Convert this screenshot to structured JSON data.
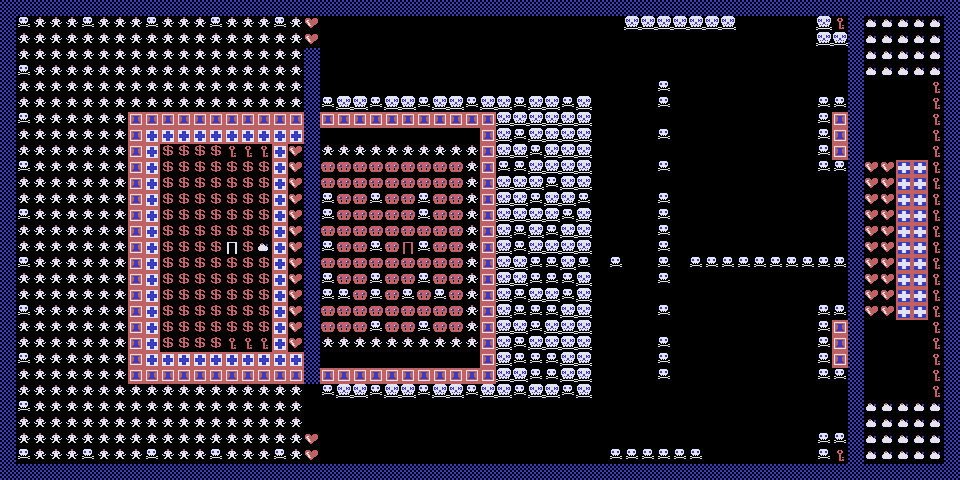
{
  "screen": {
    "type": "retro-tile-game",
    "width_tiles": 60,
    "height_tiles": 30,
    "tile_size": 16
  },
  "palette": {
    "background": "#000000",
    "blue": "#3c3cc0",
    "red": "#c16262",
    "white": "#e2e2f2",
    "black": "#000000"
  },
  "legend": {
    "#": {
      "name": "border-dither-tile",
      "interactable": false
    },
    ".": {
      "name": "empty-floor",
      "interactable": false
    },
    "m": {
      "name": "capped-monster",
      "interactable": true
    },
    "s": {
      "name": "small-skull",
      "interactable": true
    },
    "S": {
      "name": "large-skull",
      "interactable": true
    },
    "T": {
      "name": "wall-block-tile",
      "interactable": false
    },
    "+": {
      "name": "wall-cross-white-tile",
      "interactable": false
    },
    "X": {
      "name": "wall-cross-blue-tile",
      "interactable": false
    },
    "$": {
      "name": "treasure-dollar",
      "interactable": true
    },
    "k": {
      "name": "key",
      "interactable": true
    },
    "h": {
      "name": "heart",
      "interactable": true
    },
    "r": {
      "name": "red-face-monster",
      "interactable": true
    },
    "D": {
      "name": "door-red",
      "interactable": true
    },
    "d": {
      "name": "door-white",
      "interactable": true
    },
    "b": {
      "name": "money-bag",
      "interactable": true
    }
  },
  "grid": [
    "############################################################",
    "#smmmsmmmsmmmsmmmsmh...................SSSSSSS.....Sk#bbbbb#",
    "#mmmmmmmmmmmmmmmmmmh...............................SS#bbbbb#",
    "#mmmmmmmmmmmmmmmmmm#.................................#bbbbb#",
    "#smmmmmmmmmmmmmmmmm#.................................#bbbbb#",
    "#mmmmmmmmmmmmmmmmmm#.....................s...........#....k#",
    "#mmmmmmmmmmmmmmmmmm#sSSsSSsSSsSSsSSsS....s.........ss#....k#",
    "#smmmmmmTTTTTTTTTTT#TTTTTTTTTTTSSSSSS..............sT#....k#",
    "#mmmmmmmT++++++++++#..........TSsSSSS....s.........sT#....k#",
    "#mmmmmmmT+$$$$kkk+h#mmmmmmmmmmTSSsSSS..............sT#....k#",
    "#smmmmmmT+$$$$$$$+h#rrrrrrrrrmTssSSSS....s.........ss#hhXXk#",
    "#mmmmmmmT+$$$$$$$+h#rrrrrrrrrmTSSSsSS................#hhXXk#",
    "#mmmmmmmT+$$$$$$$+h#srrsrrsrrmTSSsSSs....s...........#hhXXk#",
    "#smmmmmmT+$$$$$$$+h#srrrrrsrrmTSSSSsS....s...........#hhXXk#",
    "#mmmmmmmT+$$$$$$$+h#rrrrrrrrrmTSsSsSS....s...........#hhXXk#",
    "#mmmmmmmT+$$$$d$b+h#srrsrDsrrmTSsSSSS....s...........#hhXXk#",
    "#smmmmmmT+$$$$$$$+h#rrrrrrrrrmTSSssSs.s..s.ssssssssss#hhXXk#",
    "#mmmmmmmT+$$$$$$$+h#srrsrrsrrmTSSsssS....s...........#hhXXk#",
    "#mmmmmmmT+$$$$$$$+h#ssrsrsrsrmTSsSSsS................#hhXXk#",
    "#smmmmmmT+$$$$$$$+h#rrrrrrrrrmTSsssSS....s.........ss#hhXXk#",
    "#mmmmmmmT+$$$$$$$+h#rrrsrrsrrmTSSsSSS..............sT#....k#",
    "#mmmmmmmT+$$$$kkk+h#mmmmmmmmmmTSsSSSS....s.........sT#....k#",
    "#smmmmmmT++++++++++#..........TSsssSS....s.........sT#....k#",
    "#mmmmmmmTTTTTTTTTTT#TTTTTTTTTTTSSssSS....s.........ss#....k#",
    "#mmmmmmmmmmmmmmmmmm.sSSsSSsSSsSSsSSsS................#....k#",
    "#smmmmmmmmmmmmmmmmm..................................#bbbbb#",
    "#mmmmmmmmmmmmmmmmmm..................................#bbbbb#",
    "#mmmmmmmmmmmmmmmmmmh...............................ss#bbbbb#",
    "#smmmsmmmsmmmsmmmsmh..................ssssss.......sk#bbbbb#",
    "############################################################"
  ]
}
